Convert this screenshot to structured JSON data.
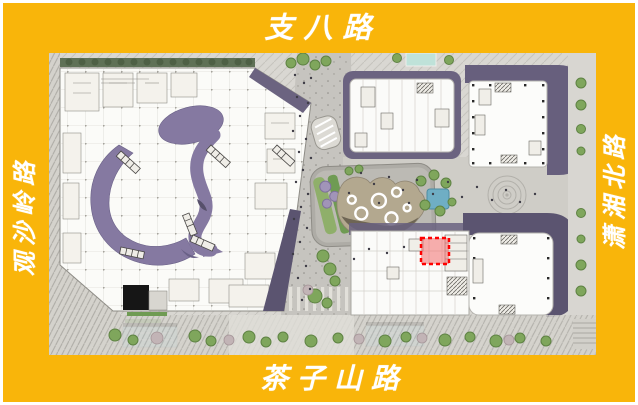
{
  "map": {
    "roads": {
      "north": "支八路",
      "south": "茶子山路",
      "west": "观沙岭路",
      "east": "潇湘北路"
    },
    "marker": {
      "type": "red-dashed-rectangle",
      "border_color": "#FF0000",
      "fill_color": "#F07070"
    },
    "colors": {
      "frame_yellow": "#F9B50A",
      "roof_purple": "#6B6380",
      "ribbon_purple": "#8579A1",
      "water_blue": "#B9DCE8",
      "tree_green": "#7FA65C"
    }
  }
}
